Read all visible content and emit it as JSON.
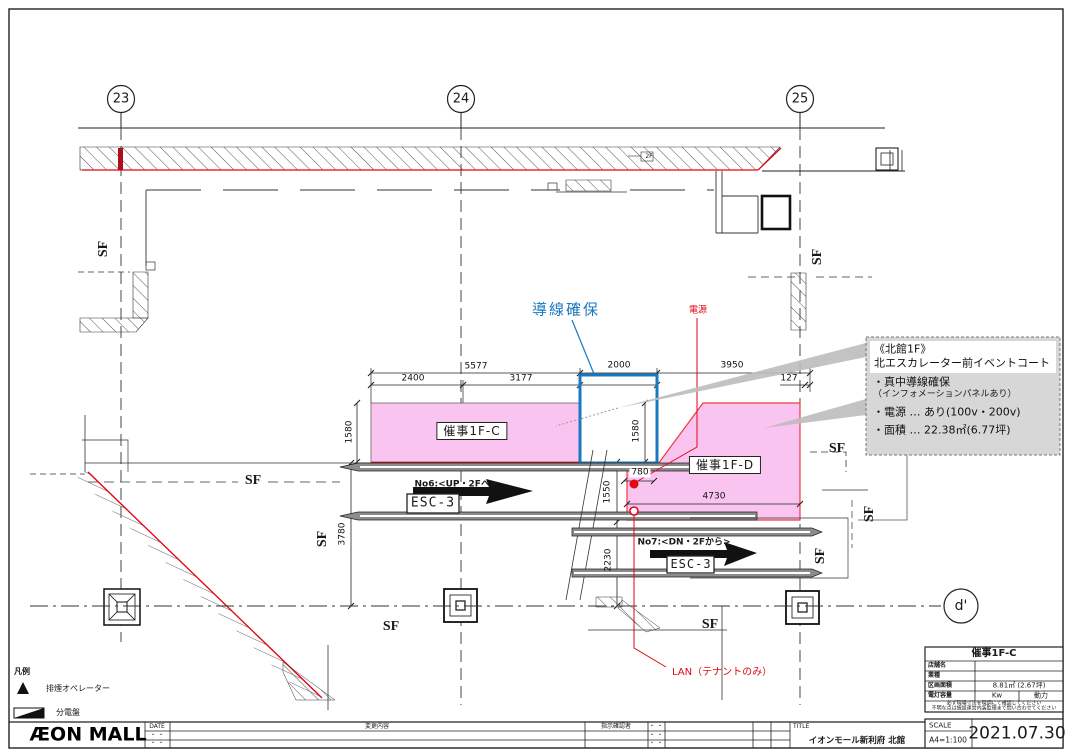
{
  "colors": {
    "pink": "#f9c4ef",
    "blue": "#1879c0",
    "red": "#e30613",
    "annotation_bg": "#d7d7d7"
  },
  "grid": {
    "col_23": "23",
    "col_24": "24",
    "col_25": "25",
    "row_d": "d'"
  },
  "labels": {
    "flow_route": "導線確保",
    "power": "電源",
    "lan": "LAN（テナントのみ）",
    "area_c": "催事1F-C",
    "area_d": "催事1F-D",
    "esc_name": "ESC-3",
    "no6": "No6:<UP・2Fへ>",
    "no7": "No7:<DN・2Fから>",
    "sf": "SF",
    "floor2": "2F"
  },
  "dims": {
    "d5577": "5577",
    "d2400": "2400",
    "d3177": "3177",
    "d2000": "2000",
    "d3950": "3950",
    "d127": "127",
    "d1580a": "1580",
    "d1580b": "1580",
    "d780": "780",
    "d1550": "1550",
    "d2230": "2230",
    "d3780": "3780",
    "d4730": "4730"
  },
  "note_box": {
    "line1": "《北館1F》",
    "line2": "北エスカレーター前イベントコート",
    "line3": "・真中導線確保",
    "line4": "（インフォメーションパネルあり）",
    "line5": "・電源 … あり(100v・200v)",
    "line6": "・面積 … 22.38㎡(6.77坪)"
  },
  "legend": {
    "title": "凡例",
    "item1": "排煙オペレーター",
    "item2": "分電盤"
  },
  "info_table": {
    "title": "催事1F-C",
    "rows": [
      {
        "label": "店舗名",
        "value": ""
      },
      {
        "label": "業種",
        "value": ""
      },
      {
        "label": "区画面積",
        "value": "8.81㎡ (2.67坪)"
      },
      {
        "label": "電灯容量",
        "value": "Kw",
        "value2": "動力"
      }
    ],
    "note1": "必ず現場寸法を現調にて確認してください",
    "note2": "不明な点は施設運営内装監理まで問い合わせてください"
  },
  "title_bar": {
    "logo": "ÆON MALL",
    "date_header": "DATE",
    "change_header": "変更内容",
    "approver_header": "指示確認者",
    "dots": "・ ・",
    "title_label": "TITLE",
    "title_value": "イオンモール新利府 北館",
    "scale_label": "SCALE",
    "scale_value": "A4=1:100",
    "date_value": "2021.07.30"
  }
}
